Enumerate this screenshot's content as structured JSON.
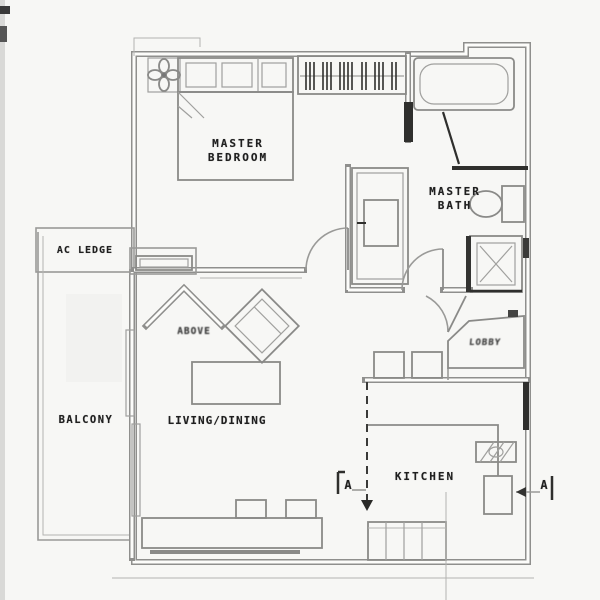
{
  "rooms": {
    "master_bedroom": {
      "line1": "MASTER",
      "line2": "BEDROOM"
    },
    "master_bath": {
      "line1": "MASTER",
      "line2": "BATH"
    },
    "ac_ledge": {
      "label": "AC LEDGE"
    },
    "balcony": {
      "label": "BALCONY"
    },
    "living_dining": {
      "label": "LIVING/DINING"
    },
    "kitchen": {
      "label": "KITCHEN"
    }
  },
  "annotations": {
    "ledge_note": "ABOVE",
    "lobby": "LOBBY",
    "section_marker_left": "A",
    "section_marker_right": "A"
  },
  "colors": {
    "paper": "#fcfcfa",
    "wall_line": "#8f8f8d",
    "wall_dark": "#2f2f2d",
    "ink": "#1f1f1f"
  }
}
